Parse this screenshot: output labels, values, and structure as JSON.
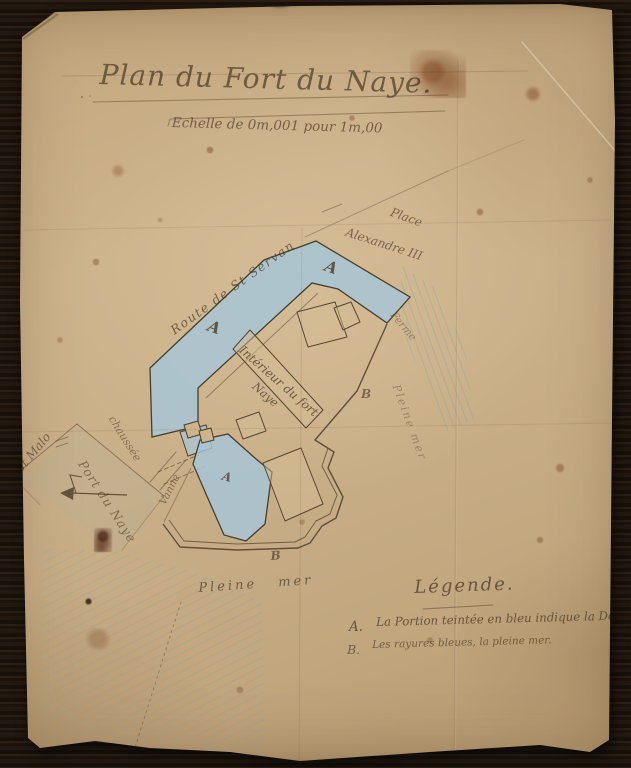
{
  "document": {
    "title": "Plan du Fort du Naye.",
    "scale_note": "Echelle de 0m,001 pour 1m,00"
  },
  "map": {
    "labels": {
      "route_st_servan": "Route de St Servan",
      "place_line1": "Place",
      "place_line2": "Alexandre III",
      "ferme": "Ferme",
      "pleine_mer_right": "Pleine mer",
      "interieur_fort_line1": "Intérieur du fort",
      "interieur_fort_line2": "Naye",
      "st_malo": "St Malo",
      "chaussee": "chaussée",
      "port_du_naye": "Port du Naye",
      "vanne": "Vanne",
      "pleine_mer_bottom": "Pleine mer",
      "marker_douve": "A",
      "marker_mer": "B"
    }
  },
  "legend": {
    "heading": "Légende.",
    "items": [
      {
        "marker": "A.",
        "text": "La Portion teintée en bleu indique la Douve."
      },
      {
        "marker": "B.",
        "text": "Les rayures bleues, la pleine mer."
      }
    ]
  },
  "colors": {
    "paper": "#c9ae86",
    "ink": "#4d3c27",
    "douve_blue": "#a6c6d8",
    "sea_hatch_blue": "#74a0a8",
    "background_wood": "#17110b"
  }
}
